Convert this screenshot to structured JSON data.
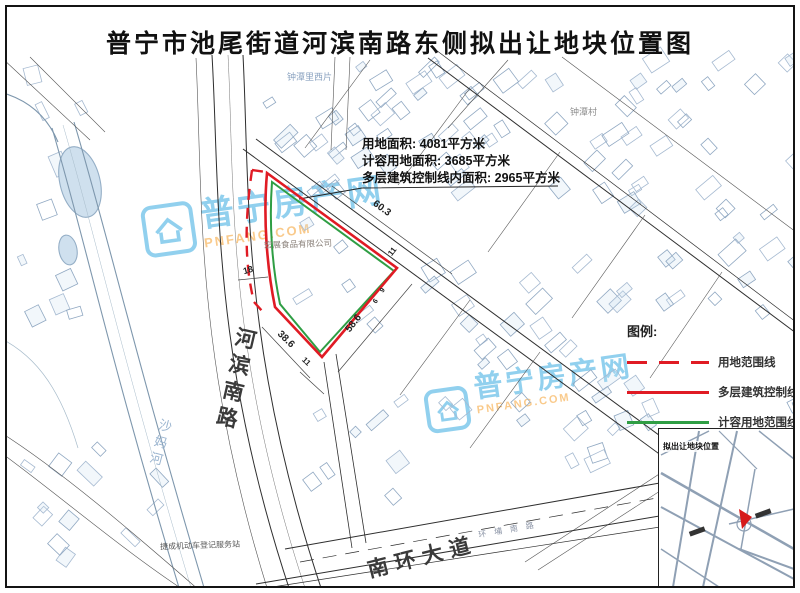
{
  "title": "普宁市池尾街道河滨南路东侧拟出让地块位置图",
  "info_box": {
    "items": [
      {
        "label": "用地面积:",
        "value": "4081平方米"
      },
      {
        "label": "计容用地面积:",
        "value": "3685平方米"
      },
      {
        "label": "多层建筑控制线内面积:",
        "value": "2965平方米"
      }
    ]
  },
  "legend": {
    "title": "图例:",
    "items": [
      {
        "label": "用地范围线",
        "line_style": "dashed",
        "color": "#e01b24"
      },
      {
        "label": "多层建筑控制线",
        "line_style": "solid",
        "color": "#e01b24"
      },
      {
        "label": "计容用地范围线",
        "line_style": "solid",
        "color": "#2f9e44"
      }
    ]
  },
  "dimensions": {
    "top_edge": "60.3",
    "right_edge": "58.6",
    "bottom_edge": "38.6",
    "west_width": "18",
    "corner_a": "11",
    "corner_b": "11",
    "small_a": "9",
    "small_b": "6"
  },
  "roads": {
    "hebin_south_road": "河滨南路",
    "nanhuan_avenue": "南环大道",
    "huanpu_south_road": "环埔南路"
  },
  "places": {
    "zhongtan_west": "钟潭里西片",
    "zhongtan_village": "钟潭村",
    "river": "沙妈河",
    "company": "宏展食品有限公司",
    "service_station": "捷成机动车登记服务站"
  },
  "watermark": {
    "name": "普宁房产网",
    "domain": "PNFANG.COM",
    "brand_blue": "#2ea7e0",
    "brand_orange": "#f59a23"
  },
  "inset": {
    "label": "拟出让地块位置",
    "marker_color": "#d61a1a"
  }
}
